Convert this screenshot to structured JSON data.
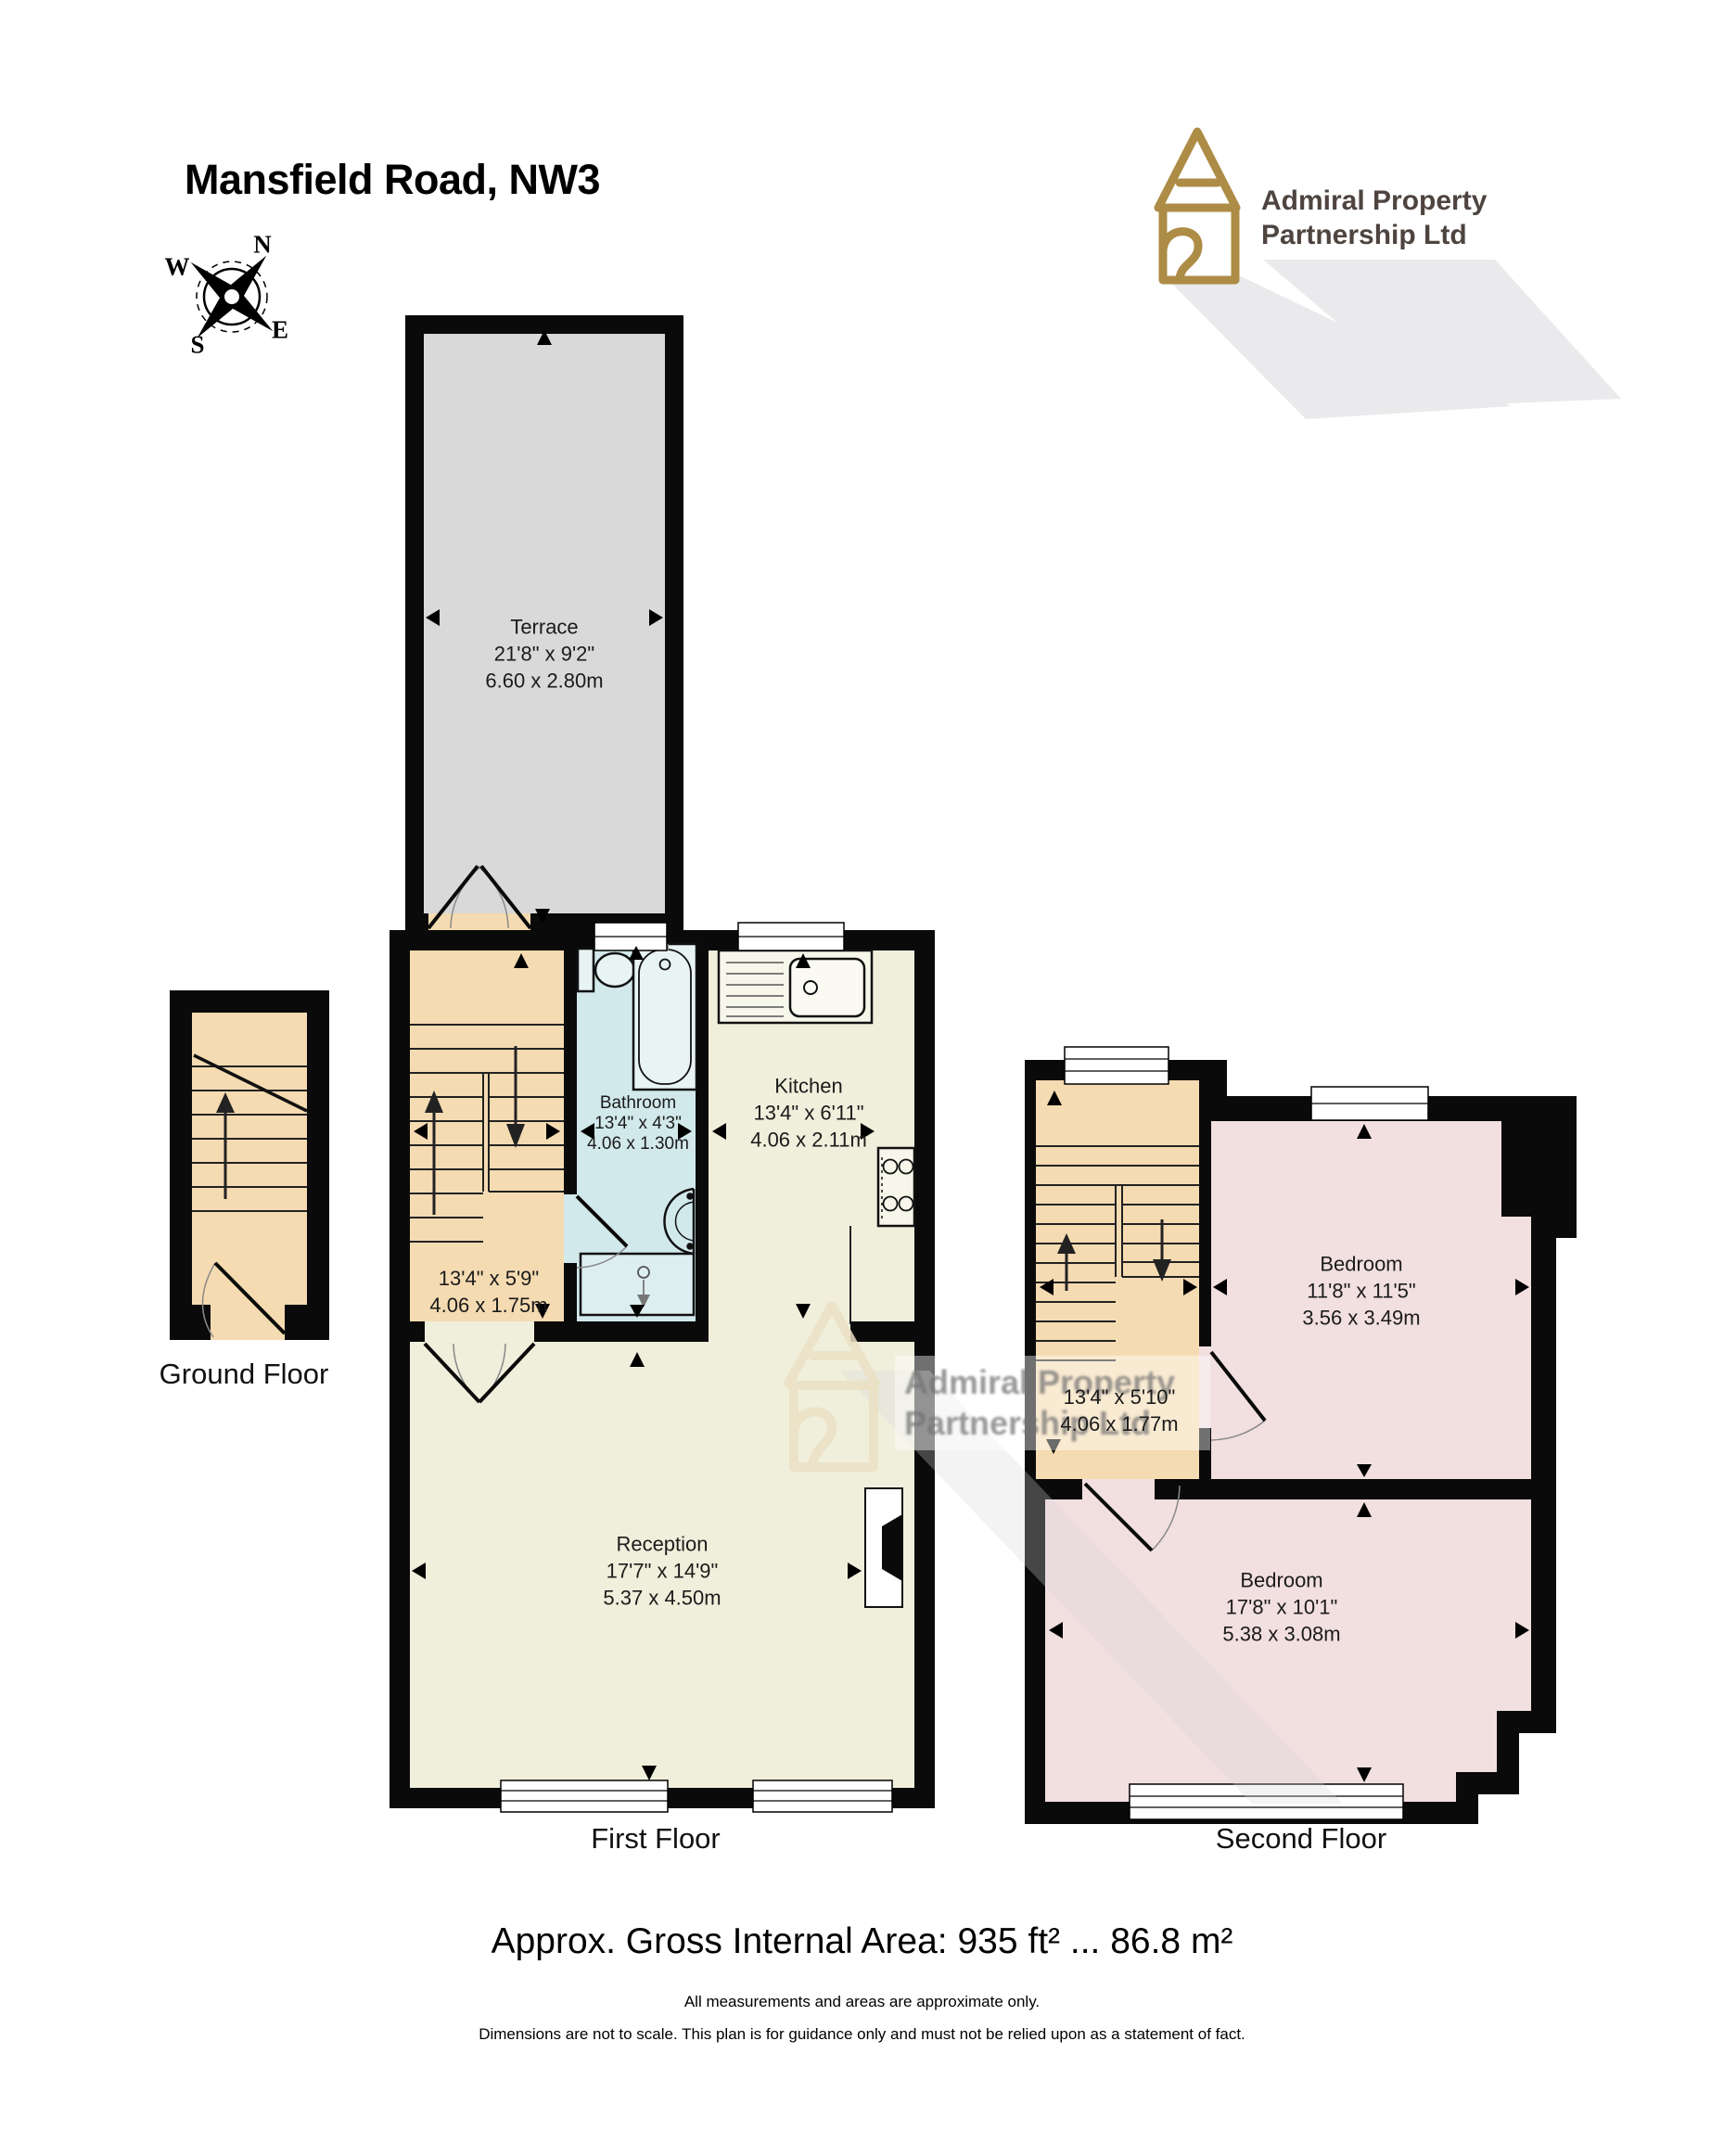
{
  "title": "Mansfield Road, NW3",
  "compass": {
    "n": "N",
    "e": "E",
    "s": "S",
    "w": "W"
  },
  "logo": {
    "line1": "Admiral Property",
    "line2": "Partnership Ltd"
  },
  "watermark": {
    "line1": "Admiral Property",
    "line2": "Partnership Ltd"
  },
  "terrace": {
    "name": "Terrace",
    "imperial": "21'8\" x 9'2\"",
    "metric": "6.60 x 2.80m"
  },
  "ground_floor": {
    "label": "Ground Floor"
  },
  "first_floor": {
    "label": "First Floor",
    "stairs": {
      "imperial": "13'4\" x 5'9\"",
      "metric": "4.06 x 1.75m"
    },
    "bathroom": {
      "name": "Bathroom",
      "imperial": "13'4\" x 4'3\"",
      "metric": "4.06 x 1.30m"
    },
    "kitchen": {
      "name": "Kitchen",
      "imperial": "13'4\" x 6'11\"",
      "metric": "4.06 x 2.11m"
    },
    "reception": {
      "name": "Reception",
      "imperial": "17'7\" x 14'9\"",
      "metric": "5.37 x 4.50m"
    }
  },
  "second_floor": {
    "label": "Second Floor",
    "stairs": {
      "imperial": "13'4\" x 5'10\"",
      "metric": "4.06 x 1.77m"
    },
    "bedroom1": {
      "name": "Bedroom",
      "imperial": "11'8\" x 11'5\"",
      "metric": "3.56 x 3.49m"
    },
    "bedroom2": {
      "name": "Bedroom",
      "imperial": "17'8\" x 10'1\"",
      "metric": "5.38 x 3.08m"
    }
  },
  "footer": {
    "area": "Approx. Gross Internal Area: 935 ft² ... 86.8 m²",
    "disclaimer1": "All measurements and areas are approximate only.",
    "disclaimer2": "Dimensions are not to scale. This plan is for guidance only and must not be relied upon as a statement of fact."
  },
  "colors": {
    "wall": "#0a0a0a",
    "terrace": "#d9d9d9",
    "stairs": "#f5dbb2",
    "bathroom": "#d2e9eb",
    "kitchen": "#f0efdc",
    "bedroom": "#f2dfe0",
    "gold": "#ad8c45"
  }
}
